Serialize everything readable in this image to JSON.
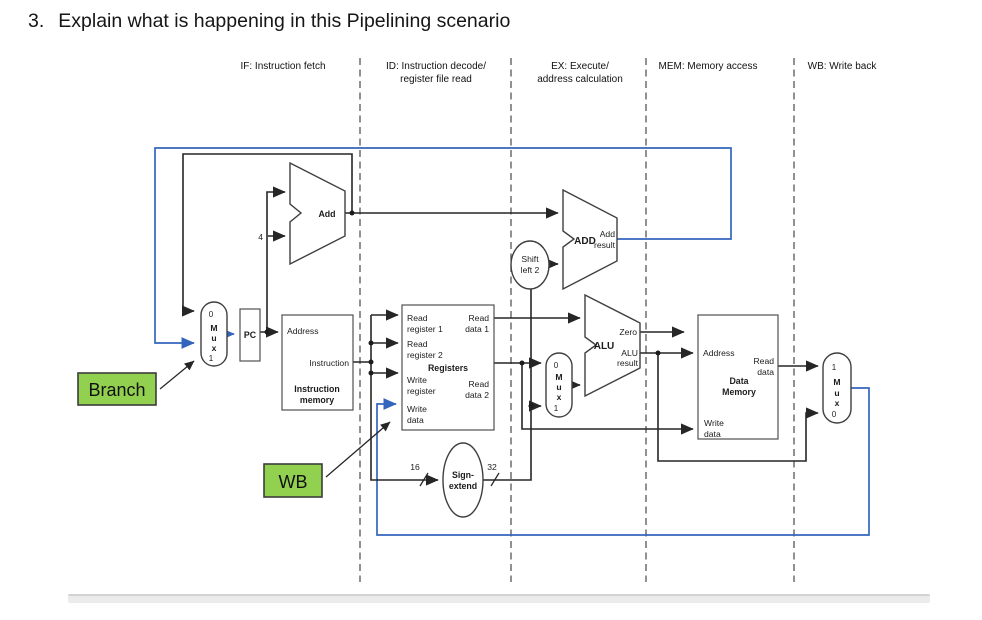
{
  "title": {
    "number": "3.",
    "text": "Explain what is happening in this Pipelining scenario"
  },
  "stages": [
    {
      "line1": "IF: Instruction fetch",
      "line2": ""
    },
    {
      "line1": "ID: Instruction decode/",
      "line2": "register file read"
    },
    {
      "line1": "EX: Execute/",
      "line2": "address calculation"
    },
    {
      "line1": "MEM: Memory access",
      "line2": ""
    },
    {
      "line1": "WB: Write back",
      "line2": ""
    }
  ],
  "components": {
    "pc": "PC",
    "pc_mux": {
      "top": "0",
      "m": "M",
      "u": "u",
      "x": "x",
      "bottom": "1"
    },
    "alusrc_mux": {
      "top": "0",
      "m": "M",
      "u": "u",
      "x": "x",
      "bottom": "1"
    },
    "wb_mux": {
      "top": "1",
      "m": "M",
      "u": "u",
      "x": "x",
      "bottom": "0"
    },
    "pc_adder": {
      "label": "Add",
      "const": "4"
    },
    "branch_adder": {
      "label": "ADD",
      "result1": "Add",
      "result2": "result"
    },
    "alu": {
      "label": "ALU",
      "zero": "Zero",
      "result1": "ALU",
      "result2": "result"
    },
    "instruction_memory": {
      "address": "Address",
      "instruction": "Instruction",
      "name1": "Instruction",
      "name2": "memory"
    },
    "registers": {
      "read_reg1_1": "Read",
      "read_reg1_2": "register 1",
      "read_data1_1": "Read",
      "read_data1_2": "data 1",
      "read_reg2_1": "Read",
      "read_reg2_2": "register 2",
      "name": "Registers",
      "write_reg_1": "Write",
      "write_reg_2": "register",
      "read_data2_1": "Read",
      "read_data2_2": "data 2",
      "write_data_1": "Write",
      "write_data_2": "data"
    },
    "sign_extend": {
      "name1": "Sign-",
      "name2": "extend",
      "in_width": "16",
      "out_width": "32"
    },
    "shift_left": {
      "name1": "Shift",
      "name2": "left 2"
    },
    "data_memory": {
      "address": "Address",
      "read_data_1": "Read",
      "read_data_2": "data",
      "name1": "Data",
      "name2": "Memory",
      "write_data_1": "Write",
      "write_data_2": "data"
    }
  },
  "annotations": {
    "branch": "Branch",
    "wb": "WB"
  },
  "colors": {
    "wire_blue": "#3465bd",
    "highlight_green": "#92d050"
  }
}
